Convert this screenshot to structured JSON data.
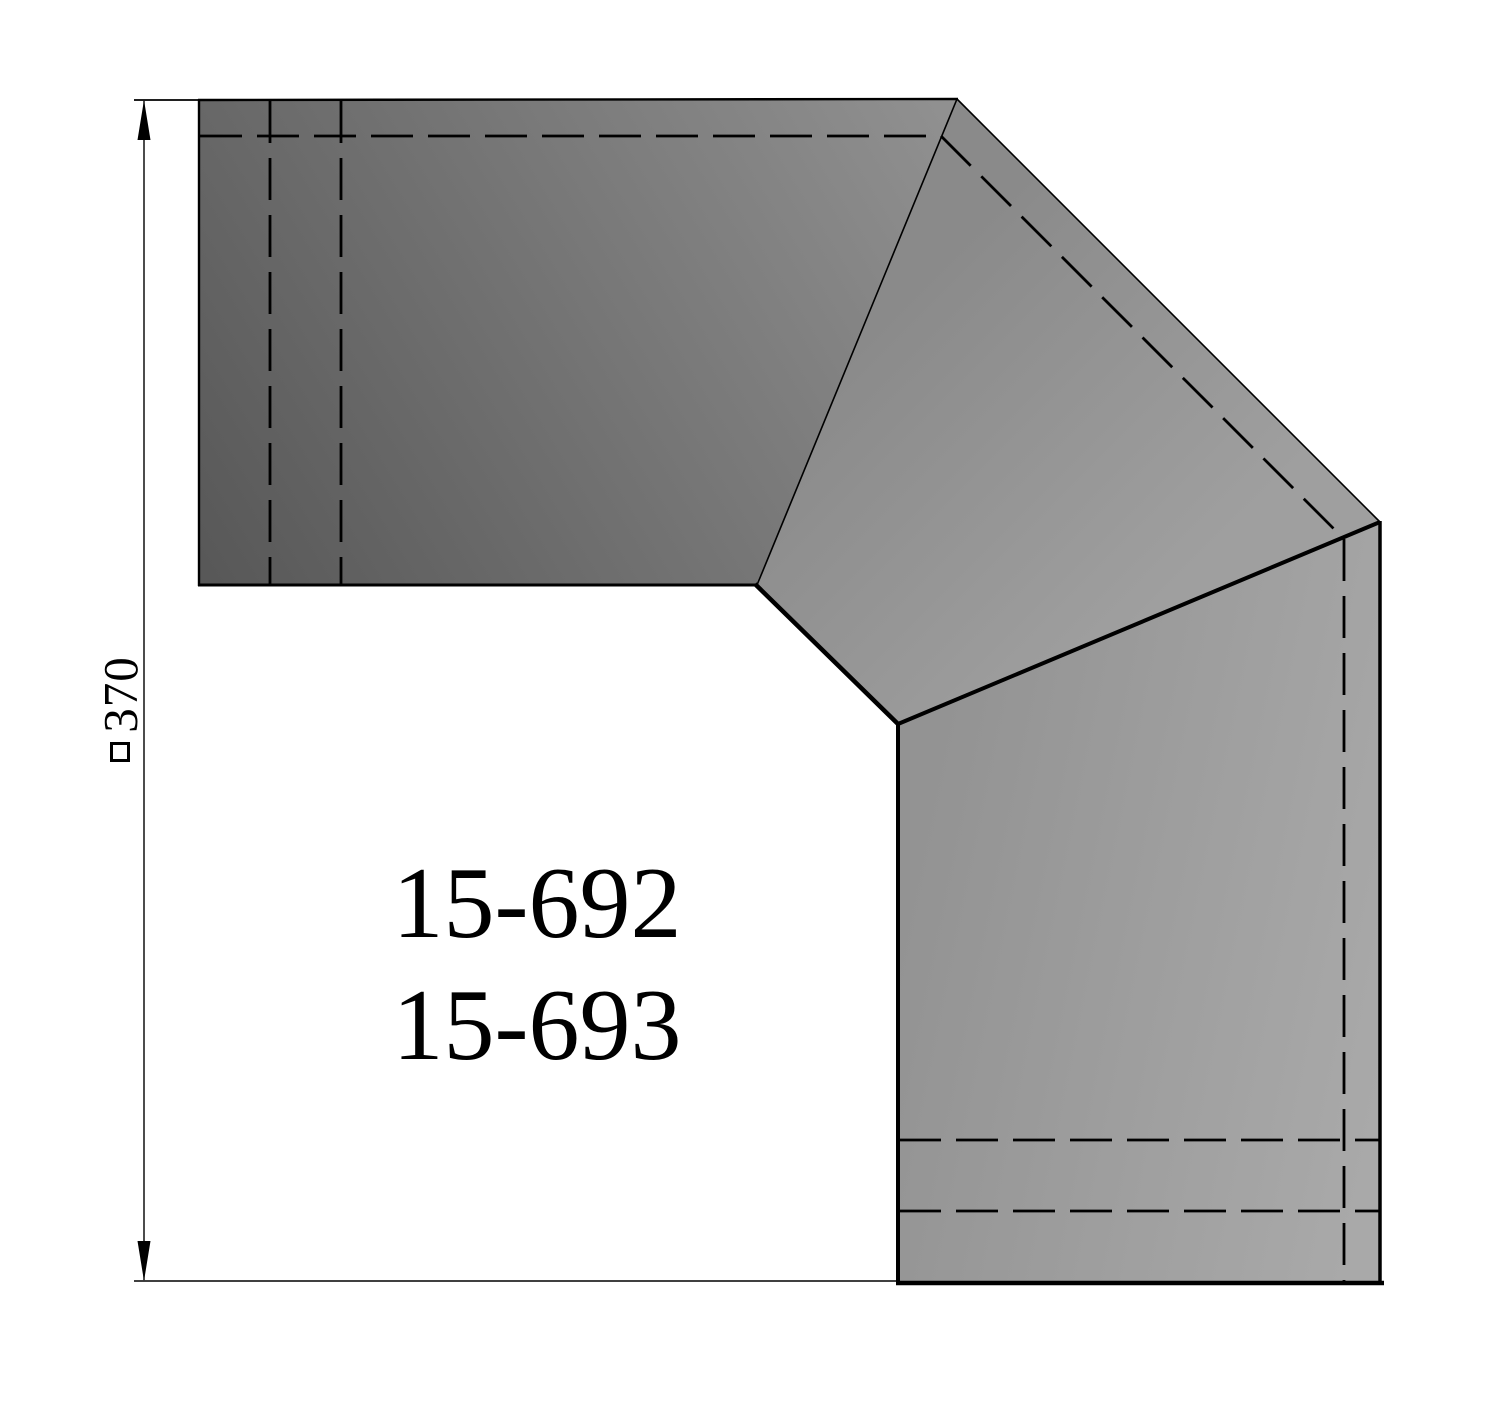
{
  "drawing": {
    "title_parts": {
      "part_number_1": "15-692",
      "part_number_2": "15-693"
    },
    "dimension": {
      "value": "370",
      "symbol": "square-section-symbol"
    },
    "colors": {
      "background": "#ffffff",
      "line": "#000000",
      "inlet_dark": "#565656",
      "inlet_light": "#919191",
      "gore_dark": "#8a8a8a",
      "gore_light": "#9f9f9f",
      "outlet_dark": "#939393",
      "outlet_light": "#a9a9a9"
    }
  }
}
